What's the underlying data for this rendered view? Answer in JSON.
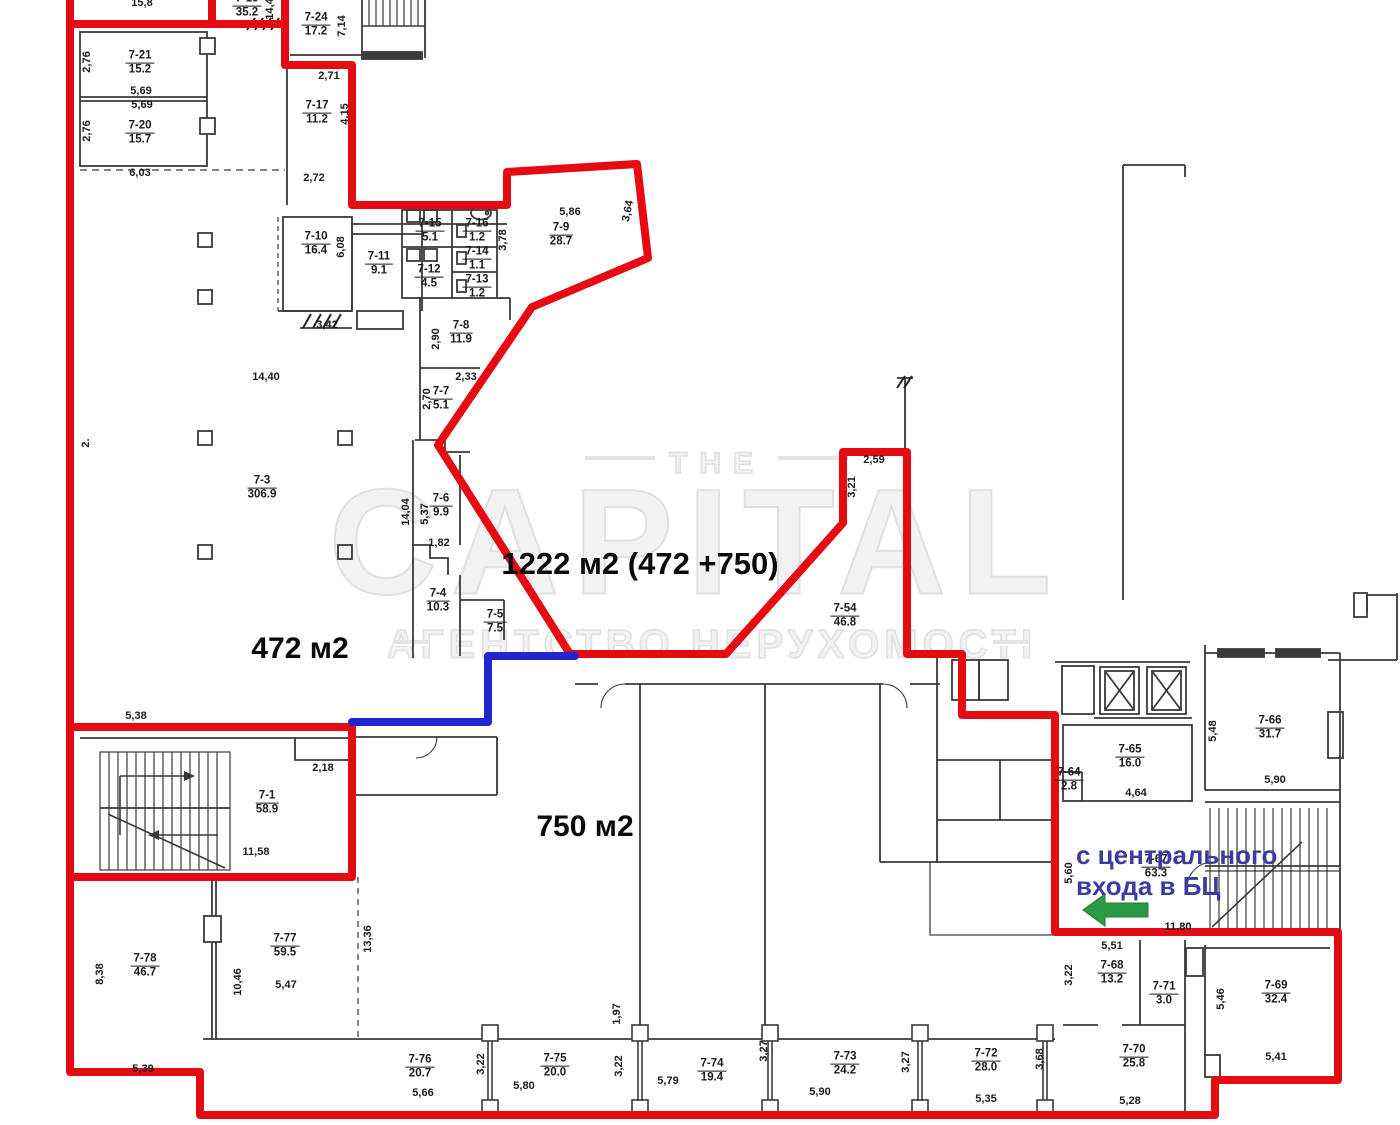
{
  "canvas": {
    "width": 1400,
    "height": 1125,
    "background": "#ffffff"
  },
  "colors": {
    "lease_outline_red": "#e40b12",
    "divider_blue": "#2424cf",
    "note_text_blue": "#3c3c9e",
    "entrance_arrow_green": "#2a9a44",
    "wall_gray": "#3a3a3a",
    "watermark_gray": "#e0e0e0"
  },
  "watermark": {
    "the": "THE",
    "brand": "CAPITAL",
    "subtitle": "АГЕНТСТВО НЕРУХОМОСТІ"
  },
  "entrance_note": {
    "line1": "с центрального",
    "line2": "входа в БЦ",
    "arrow_direction": "left"
  },
  "area_labels": [
    {
      "id": "total-area",
      "text": "1222 м2 (472 +750)",
      "x": 640,
      "y": 564,
      "size": 31
    },
    {
      "id": "left-area",
      "text": "472 м2",
      "x": 300,
      "y": 649,
      "size": 30
    },
    {
      "id": "bottom-area",
      "text": "750 м2",
      "x": 585,
      "y": 827,
      "size": 30
    }
  ],
  "rooms": [
    {
      "n": "7-19",
      "a": "35.2",
      "x": 247,
      "y": 6
    },
    {
      "n": "7-24",
      "a": "17.2",
      "x": 316,
      "y": 25
    },
    {
      "n": "7-21",
      "a": "15.2",
      "x": 140,
      "y": 63
    },
    {
      "n": "7-20",
      "a": "15.7",
      "x": 140,
      "y": 133
    },
    {
      "n": "7-17",
      "a": "11.2",
      "x": 317,
      "y": 113
    },
    {
      "n": "7-10",
      "a": "16.4",
      "x": 316,
      "y": 244
    },
    {
      "n": "7-11",
      "a": "9.1",
      "x": 379,
      "y": 264
    },
    {
      "n": "7-15",
      "a": "5.1",
      "x": 430,
      "y": 231
    },
    {
      "n": "7-16",
      "a": "1.2",
      "x": 477,
      "y": 231
    },
    {
      "n": "7-14",
      "a": "1.1",
      "x": 477,
      "y": 259
    },
    {
      "n": "7-13",
      "a": "1.2",
      "x": 477,
      "y": 287
    },
    {
      "n": "7-12",
      "a": "4.5",
      "x": 429,
      "y": 277
    },
    {
      "n": "7-9",
      "a": "28.7",
      "x": 561,
      "y": 235
    },
    {
      "n": "7-8",
      "a": "11.9",
      "x": 461,
      "y": 333
    },
    {
      "n": "7-7",
      "a": "5.1",
      "x": 441,
      "y": 399
    },
    {
      "n": "7-6",
      "a": "9.9",
      "x": 441,
      "y": 506
    },
    {
      "n": "7-4",
      "a": "10.3",
      "x": 438,
      "y": 601
    },
    {
      "n": "7-5",
      "a": "7.5",
      "x": 495,
      "y": 622
    },
    {
      "n": "7-3",
      "a": "306.9",
      "x": 262,
      "y": 488
    },
    {
      "n": "7-54",
      "a": "46.8",
      "x": 845,
      "y": 616
    },
    {
      "n": "7-1",
      "a": "58.9",
      "x": 267,
      "y": 803
    },
    {
      "n": "7-66",
      "a": "31.7",
      "x": 1270,
      "y": 728
    },
    {
      "n": "7-65",
      "a": "16.0",
      "x": 1130,
      "y": 757
    },
    {
      "n": "7-64",
      "a": "2.8",
      "x": 1069,
      "y": 780
    },
    {
      "n": "7-67",
      "a": "63.3",
      "x": 1156,
      "y": 867
    },
    {
      "n": "7-68",
      "a": "13.2",
      "x": 1112,
      "y": 973
    },
    {
      "n": "7-71",
      "a": "3.0",
      "x": 1164,
      "y": 994
    },
    {
      "n": "7-69",
      "a": "32.4",
      "x": 1276,
      "y": 993
    },
    {
      "n": "7-70",
      "a": "25.8",
      "x": 1134,
      "y": 1057
    },
    {
      "n": "7-78",
      "a": "46.7",
      "x": 145,
      "y": 966
    },
    {
      "n": "7-77",
      "a": "59.5",
      "x": 285,
      "y": 946
    },
    {
      "n": "7-76",
      "a": "20.7",
      "x": 420,
      "y": 1067
    },
    {
      "n": "7-75",
      "a": "20.0",
      "x": 555,
      "y": 1066
    },
    {
      "n": "7-74",
      "a": "19.4",
      "x": 712,
      "y": 1071
    },
    {
      "n": "7-73",
      "a": "24.2",
      "x": 845,
      "y": 1064
    },
    {
      "n": "7-72",
      "a": "28.0",
      "x": 986,
      "y": 1061
    }
  ],
  "dims": [
    {
      "t": "15,8",
      "x": 142,
      "y": 3,
      "r": 0
    },
    {
      "t": "14,4",
      "x": 270,
      "y": 9,
      "r": -90
    },
    {
      "t": "7,14",
      "x": 342,
      "y": 26,
      "r": -90
    },
    {
      "t": "2,76",
      "x": 87,
      "y": 62,
      "r": -90
    },
    {
      "t": "5,69",
      "x": 141,
      "y": 91,
      "r": 0
    },
    {
      "t": "5,69",
      "x": 142,
      "y": 105,
      "r": 0
    },
    {
      "t": "2,76",
      "x": 87,
      "y": 131,
      "r": -90
    },
    {
      "t": "2,71",
      "x": 329,
      "y": 76,
      "r": 0
    },
    {
      "t": "4,15",
      "x": 345,
      "y": 114,
      "r": -90
    },
    {
      "t": "6,03",
      "x": 140,
      "y": 173,
      "r": 0
    },
    {
      "t": "2,72",
      "x": 314,
      "y": 178,
      "r": 0
    },
    {
      "t": "6,08",
      "x": 341,
      "y": 247,
      "r": -90
    },
    {
      "t": "3,42",
      "x": 327,
      "y": 325,
      "r": 0
    },
    {
      "t": "3,78",
      "x": 503,
      "y": 240,
      "r": -90
    },
    {
      "t": "5,86",
      "x": 570,
      "y": 212,
      "r": 0
    },
    {
      "t": "3,64",
      "x": 628,
      "y": 211,
      "r": -78
    },
    {
      "t": "2,90",
      "x": 436,
      "y": 339,
      "r": -90
    },
    {
      "t": "2,33",
      "x": 466,
      "y": 377,
      "r": 0
    },
    {
      "t": "2,70",
      "x": 427,
      "y": 399,
      "r": -90
    },
    {
      "t": "14,04",
      "x": 406,
      "y": 512,
      "r": -90
    },
    {
      "t": "5,37",
      "x": 425,
      "y": 514,
      "r": -90
    },
    {
      "t": "1,82",
      "x": 439,
      "y": 543,
      "r": 0
    },
    {
      "t": "14,40",
      "x": 266,
      "y": 377,
      "r": 0
    },
    {
      "t": "2.",
      "x": 86,
      "y": 443,
      "r": -90
    },
    {
      "t": "2,59",
      "x": 874,
      "y": 460,
      "r": 0
    },
    {
      "t": "3,21",
      "x": 852,
      "y": 487,
      "r": -90
    },
    {
      "t": "5,38",
      "x": 136,
      "y": 716,
      "r": 0
    },
    {
      "t": "2,18",
      "x": 323,
      "y": 768,
      "r": 0
    },
    {
      "t": "11,58",
      "x": 256,
      "y": 852,
      "r": 0
    },
    {
      "t": "5,48",
      "x": 1213,
      "y": 731,
      "r": -90
    },
    {
      "t": "5,90",
      "x": 1275,
      "y": 780,
      "r": 0
    },
    {
      "t": "4,64",
      "x": 1136,
      "y": 793,
      "r": 0
    },
    {
      "t": "5,60",
      "x": 1069,
      "y": 873,
      "r": -90
    },
    {
      "t": "11,80",
      "x": 1178,
      "y": 927,
      "r": 0
    },
    {
      "t": "5,51",
      "x": 1112,
      "y": 946,
      "r": 0
    },
    {
      "t": "3,22",
      "x": 1069,
      "y": 975,
      "r": -90
    },
    {
      "t": "5,46",
      "x": 1221,
      "y": 999,
      "r": -90
    },
    {
      "t": "5,41",
      "x": 1276,
      "y": 1057,
      "r": 0
    },
    {
      "t": "5,28",
      "x": 1130,
      "y": 1101,
      "r": 0
    },
    {
      "t": "3,68",
      "x": 1040,
      "y": 1059,
      "r": -90
    },
    {
      "t": "3,27",
      "x": 906,
      "y": 1062,
      "r": -90
    },
    {
      "t": "3,27",
      "x": 764,
      "y": 1051,
      "r": -90
    },
    {
      "t": "5,90",
      "x": 820,
      "y": 1092,
      "r": 0
    },
    {
      "t": "5,35",
      "x": 986,
      "y": 1099,
      "r": 0
    },
    {
      "t": "3,22",
      "x": 481,
      "y": 1064,
      "r": -90
    },
    {
      "t": "3,22",
      "x": 619,
      "y": 1066,
      "r": -90
    },
    {
      "t": "1,97",
      "x": 617,
      "y": 1014,
      "r": -90
    },
    {
      "t": "5,80",
      "x": 524,
      "y": 1086,
      "r": 0
    },
    {
      "t": "5,79",
      "x": 668,
      "y": 1081,
      "r": 0
    },
    {
      "t": "5,66",
      "x": 423,
      "y": 1093,
      "r": 0
    },
    {
      "t": "5,47",
      "x": 286,
      "y": 985,
      "r": 0
    },
    {
      "t": "10,46",
      "x": 238,
      "y": 982,
      "r": -90
    },
    {
      "t": "13,36",
      "x": 368,
      "y": 939,
      "r": -90
    },
    {
      "t": "8,38",
      "x": 100,
      "y": 974,
      "r": -90
    },
    {
      "t": "5,39",
      "x": 143,
      "y": 1069,
      "r": 0
    }
  ]
}
